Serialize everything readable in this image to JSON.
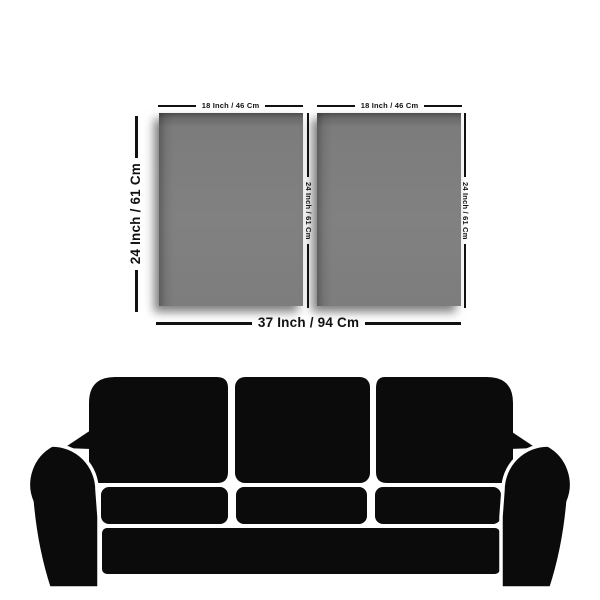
{
  "title": "Two-panel canvas size diagram above sofa",
  "colors": {
    "background": "#ffffff",
    "panel_gray": "#7f7f7f",
    "panel_edge_dark": "#4e4e4e",
    "sofa_black": "#0b0b0b",
    "dimension_text": "#111111"
  },
  "diagram": {
    "panels": [
      {
        "width_label": "18 Inch / 46 Cm",
        "height_label": "24 Inch / 61 Cm"
      },
      {
        "width_label": "18 Inch / 46 Cm",
        "height_label": "24 Inch / 61 Cm"
      }
    ],
    "overall_height_label": "24 Inch / 61 Cm",
    "overall_width_label": "37 Inch / 94 Cm"
  },
  "sofa": {
    "type": "three-seater-sofa-silhouette",
    "seat_count": 3
  }
}
